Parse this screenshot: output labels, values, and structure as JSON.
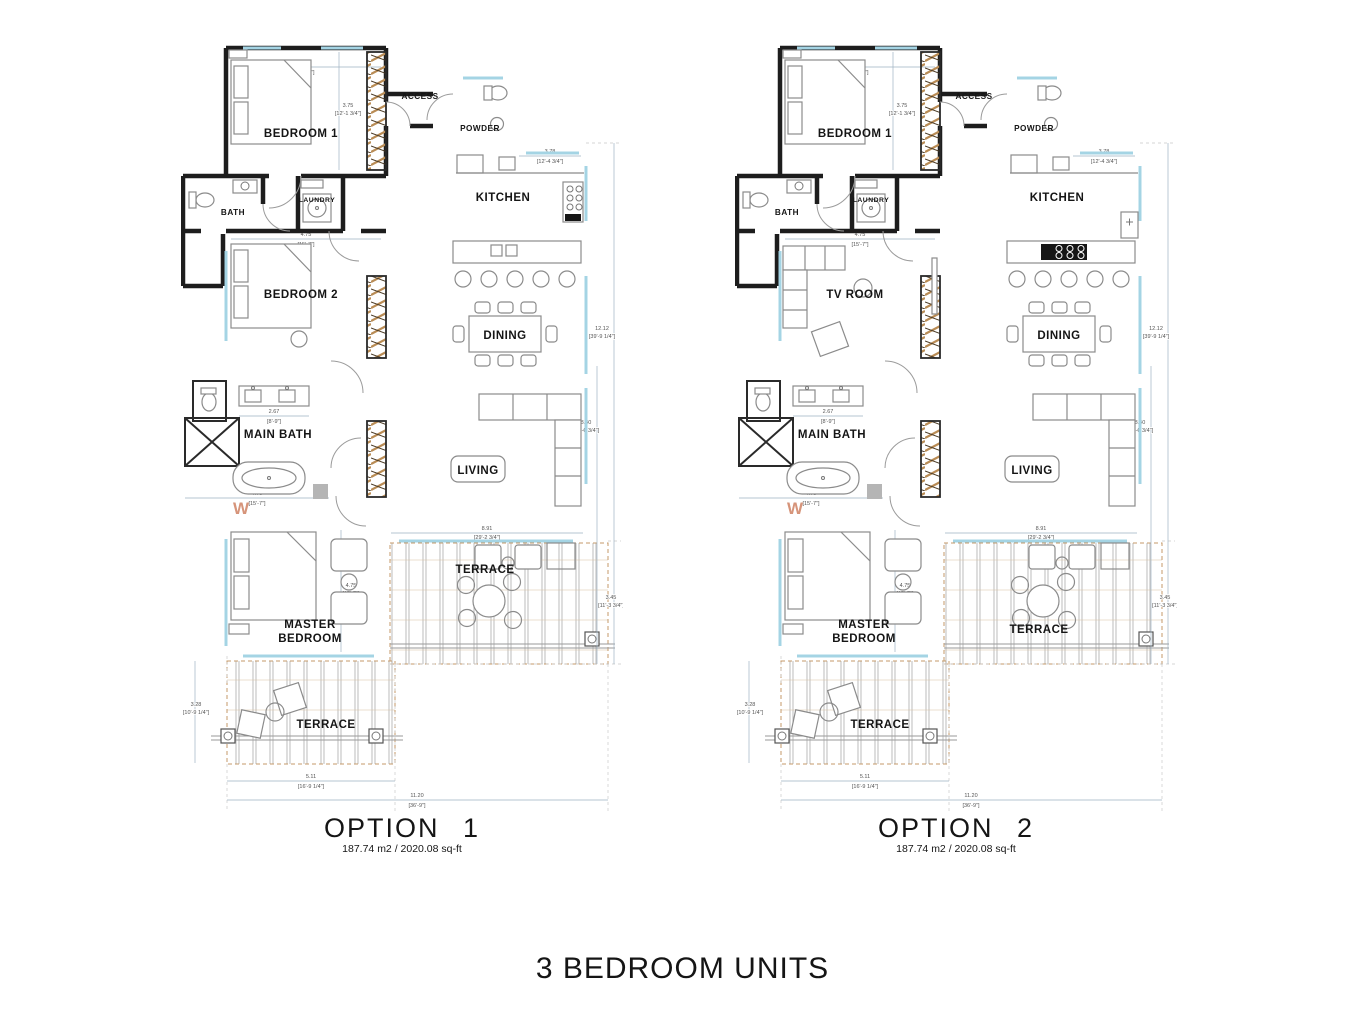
{
  "page_title": "3 BEDROOM UNITS",
  "options": [
    {
      "title": "OPTION 1",
      "area": "187.74 m2 / 2020.08 sq-ft",
      "room2_furniture": "bed",
      "terrace_side_label_y": "537",
      "rooms": {
        "bedroom1": "BEDROOM 1",
        "access": "ACCESS",
        "powder": "POWDER",
        "kitchen": "KITCHEN",
        "bath": "BATH",
        "laundry": "LAUNDRY",
        "room2": "BEDROOM 2",
        "dining": "DINING",
        "main_bath": "MAIN  BATH",
        "living": "LIVING",
        "master_line1": "MASTER",
        "master_line2": "BEDROOM",
        "terrace_side": "TERRACE",
        "terrace_bottom": "TERRACE"
      }
    },
    {
      "title": "OPTION 2",
      "area": "187.74 m2 / 2020.08 sq-ft",
      "room2_furniture": "sofa",
      "terrace_side_label_y": "597",
      "rooms": {
        "bedroom1": "BEDROOM 1",
        "access": "ACCESS",
        "powder": "POWDER",
        "kitchen": "KITCHEN",
        "bath": "BATH",
        "laundry": "LAUNDRY",
        "room2": "TV  ROOM",
        "dining": "DINING",
        "main_bath": "MAIN  BATH",
        "living": "LIVING",
        "master_line1": "MASTER",
        "master_line2": "BEDROOM",
        "terrace_side": "TERRACE",
        "terrace_bottom": "TERRACE"
      }
    }
  ],
  "dimensions": {
    "bedroom1_w_m": "4.75",
    "bedroom1_w_ft": "[15'-7\"]",
    "bedroom1_h_m": "3.75",
    "bedroom1_h_ft": "[12'-1 3/4\"]",
    "kitchen_w_m": "3.78",
    "kitchen_w_ft": "[12'-4 3/4\"]",
    "room2_w_m": "4.75",
    "room2_w_ft": "[15'-7\"]",
    "vanity_w_m": "2.67",
    "vanity_w_ft": "[8'-9\"]",
    "mainbath_w_m": "4.75",
    "mainbath_w_ft": "[15'-7\"]",
    "master_h_m": "4.75",
    "master_h_ft": "[15'-7\"]",
    "overall_h_m": "12.12",
    "overall_h_ft": "[39'-9 1/4\"]",
    "living_h_m": "8.40",
    "living_h_ft": "[27'-6 3/4\"]",
    "living_w_m": "8.91",
    "living_w_ft": "[29'-2 3/4\"]",
    "terrace_side_h_m": "3.45",
    "terrace_side_h_ft": "[11'-3 3/4\"]",
    "terrace_bottom_w_m": "5.11",
    "terrace_bottom_w_ft": "[16'-9 1/4\"]",
    "overall_w_m": "11.20",
    "overall_w_ft": "[36'-9\"]",
    "terrace_bottom_h_m": "3.28",
    "terrace_bottom_h_ft": "[10'-9 1/4\"]"
  },
  "annotations": {
    "window_mark": "W"
  },
  "colors": {
    "wall": "#1d1d1d",
    "window_glazing": "#a4d4e4",
    "closet_hatch": "#b98c55",
    "deck_line": "#ababab",
    "deck_dash": "#c49a6a",
    "dimension_line": "#9fb3c2",
    "accent_orange": "#cf8263",
    "text": "#151515"
  }
}
